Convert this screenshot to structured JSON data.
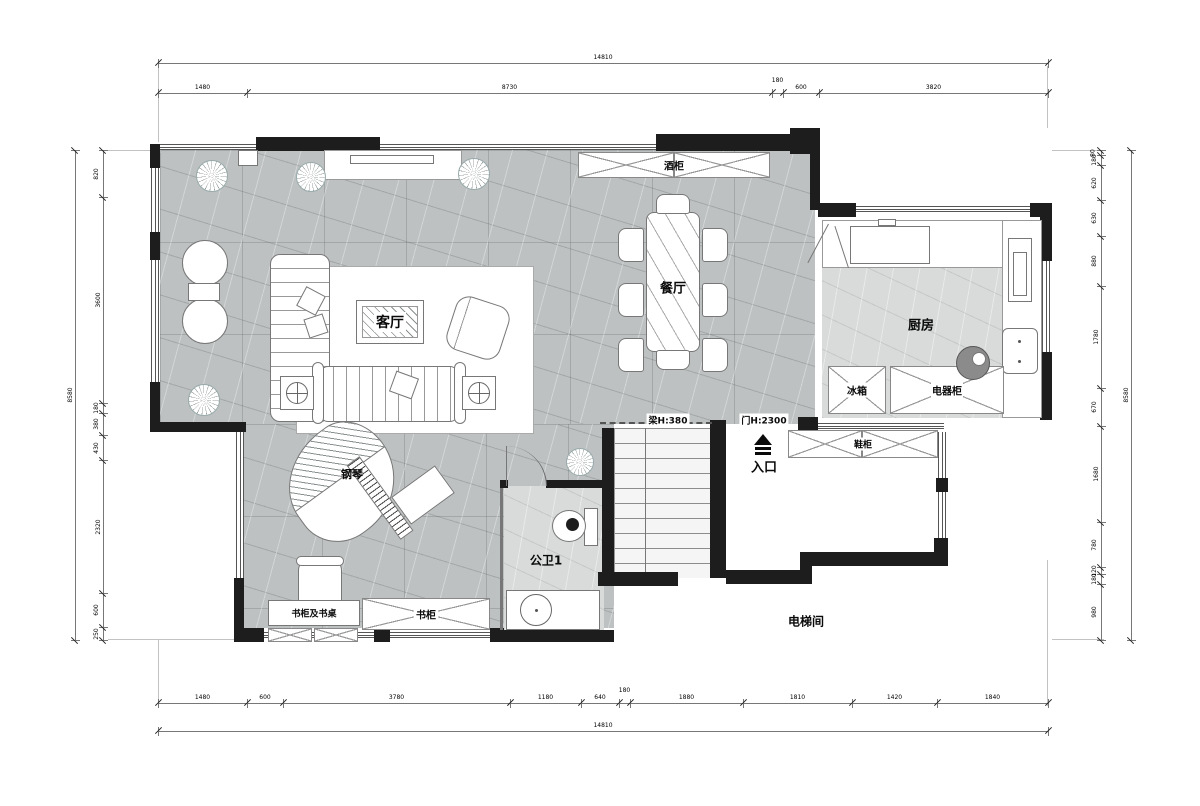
{
  "plan": {
    "rooms": {
      "living": "客厅",
      "dining": "餐厅",
      "kitchen": "厨房",
      "bath": "公卫1",
      "elevator": "电梯间",
      "entrance": "入口",
      "piano": "钢琴"
    },
    "furniture": {
      "fridge": "冰箱",
      "appliance_cabinet": "电器柜",
      "shoe_cabinet": "鞋柜",
      "bookcase_desk": "书柜及书桌",
      "bookcase": "书柜",
      "wine_cabinet": "酒柜"
    },
    "annotations": {
      "beam": "梁H:380",
      "door_height": "门H:2300"
    }
  },
  "dimensions": {
    "top": {
      "total": "14810",
      "segments": [
        "1480",
        "8730",
        "180",
        "600",
        "3820"
      ]
    },
    "bottom": {
      "total": "14810",
      "segments": [
        "1480",
        "600",
        "3780",
        "1180",
        "640",
        "180",
        "1880",
        "1810",
        "1420",
        "1840"
      ]
    },
    "left": {
      "total": "8580",
      "segments": [
        "820",
        "3600",
        "180",
        "380",
        "430",
        "2320",
        "600",
        "250"
      ]
    },
    "right": {
      "total": "8580",
      "segments": [
        "80",
        "180",
        "620",
        "630",
        "880",
        "1780",
        "670",
        "1680",
        "780",
        "120",
        "180",
        "980"
      ]
    }
  },
  "colors": {
    "wall": "#1d1d1d",
    "floor": "#bdc1c2",
    "floor_light": "#d9dbdb",
    "dimension_line": "#777777"
  }
}
